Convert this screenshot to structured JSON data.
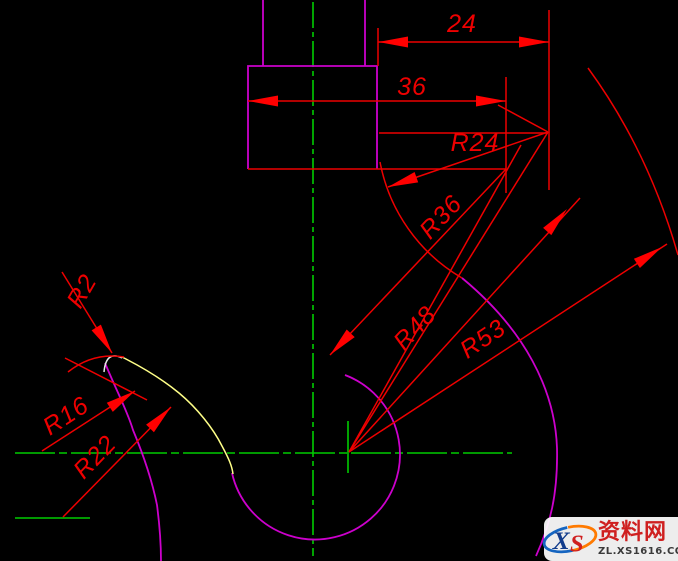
{
  "dim_labels": {
    "d24": "24",
    "d36": "36",
    "r24": "R24",
    "r36": "R36",
    "r48": "R48",
    "r53": "R53",
    "r2": "R2",
    "r16": "R16",
    "r22": "R22"
  },
  "watermark": {
    "site_name": "资料网",
    "url": "ZL.XS1616.COM",
    "logo_x": "X",
    "logo_s": "S"
  },
  "colors": {
    "background": "#000000",
    "dimension_red": "#ee0000",
    "arrow_red": "#ff0000",
    "centerline_green": "#00cc00",
    "outline_magenta": "#cc00cc",
    "tip_inner_yellow": "#ffff88",
    "tip_white": "#e8e8e8",
    "watermark_red": "#cf2020",
    "watermark_url_gray": "#3a3a3a",
    "logo_blue": "#1565c0",
    "logo_orange": "#ff7a00"
  }
}
